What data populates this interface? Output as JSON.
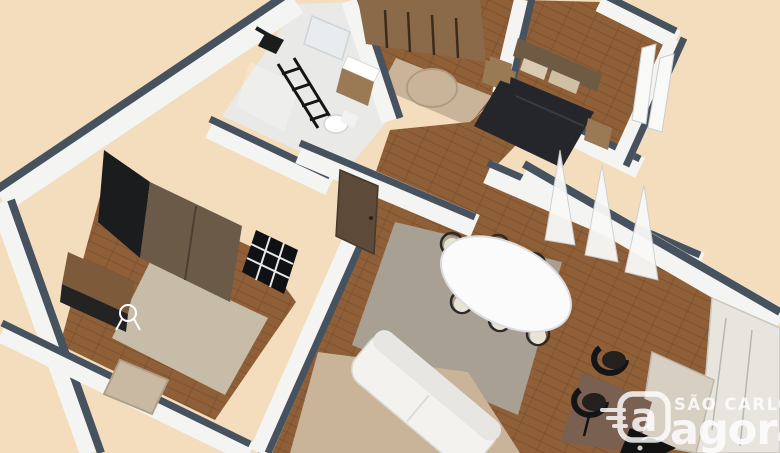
{
  "scene": {
    "type": "3d-floor-plan-render",
    "description": "Isometric 3D rendering of an apartment floor plan viewed from above at an angle, on a peach background",
    "background_color": "#f3ddbd",
    "colors": {
      "wall_cap": "#47525f",
      "wall_face": "#f4f4f3",
      "wall_face_shade": "#d9dadb",
      "wood_floor": "#8f6038",
      "wood_floor_dark": "#74492a",
      "bath_floor": "#e9e9e7",
      "rug_beige": "#c9b49a",
      "rug_gray": "#a8a093",
      "rug_office": "#c6bca8",
      "wardrobe_brown": "#8b6a49",
      "furniture_wood": "#9a7a55",
      "dark_furniture": "#1b1c1e",
      "bed_duvet": "#25262c",
      "headboard_brown": "#6f5b43",
      "door_brown": "#5d4a38",
      "sofa_white": "#f3f2ef",
      "table_white": "#fbfbfb",
      "chair_seat": "#e9e3d3",
      "marble_counter": "#d6cfc2",
      "island_brown": "#7a6051",
      "cabinet_gray": "#e8e5df",
      "curtain_white": "#f9f9f8"
    },
    "rooms": [
      {
        "name": "bedroom-suite",
        "furniture": [
          "brown-wardrobe",
          "round-pouf",
          "double-bed-dark-duvet",
          "upholstered-headboard",
          "nightstands",
          "small-dresser",
          "window-curtains"
        ]
      },
      {
        "name": "bathroom",
        "furniture": [
          "vanity-sink",
          "mirror",
          "toilet",
          "shower-head",
          "black-ladder-shelf"
        ]
      },
      {
        "name": "office",
        "furniture": [
          "dark-wardrobe",
          "desk",
          "white-wire-chair",
          "beige-armchair",
          "black-grid-window",
          "beige-rug"
        ]
      },
      {
        "name": "hallway",
        "furniture": [
          "wooden-door"
        ]
      },
      {
        "name": "living-dining-room",
        "furniture": [
          "white-oval-dining-table",
          "six-dining-chairs",
          "gray-rug",
          "white-sofa",
          "beige-rug",
          "sheer-curtains"
        ]
      },
      {
        "name": "kitchen",
        "furniture": [
          "island-counter",
          "black-bar-stools",
          "black-cooktop",
          "marble-counter",
          "gray-cabinets"
        ]
      }
    ]
  },
  "watermark": {
    "line1": "SÃO CARLOS",
    "line2": "agora",
    "icon_letter": "a",
    "icon": "agora-a-badge-icon",
    "color": "#ffffff",
    "opacity": "0.82"
  }
}
